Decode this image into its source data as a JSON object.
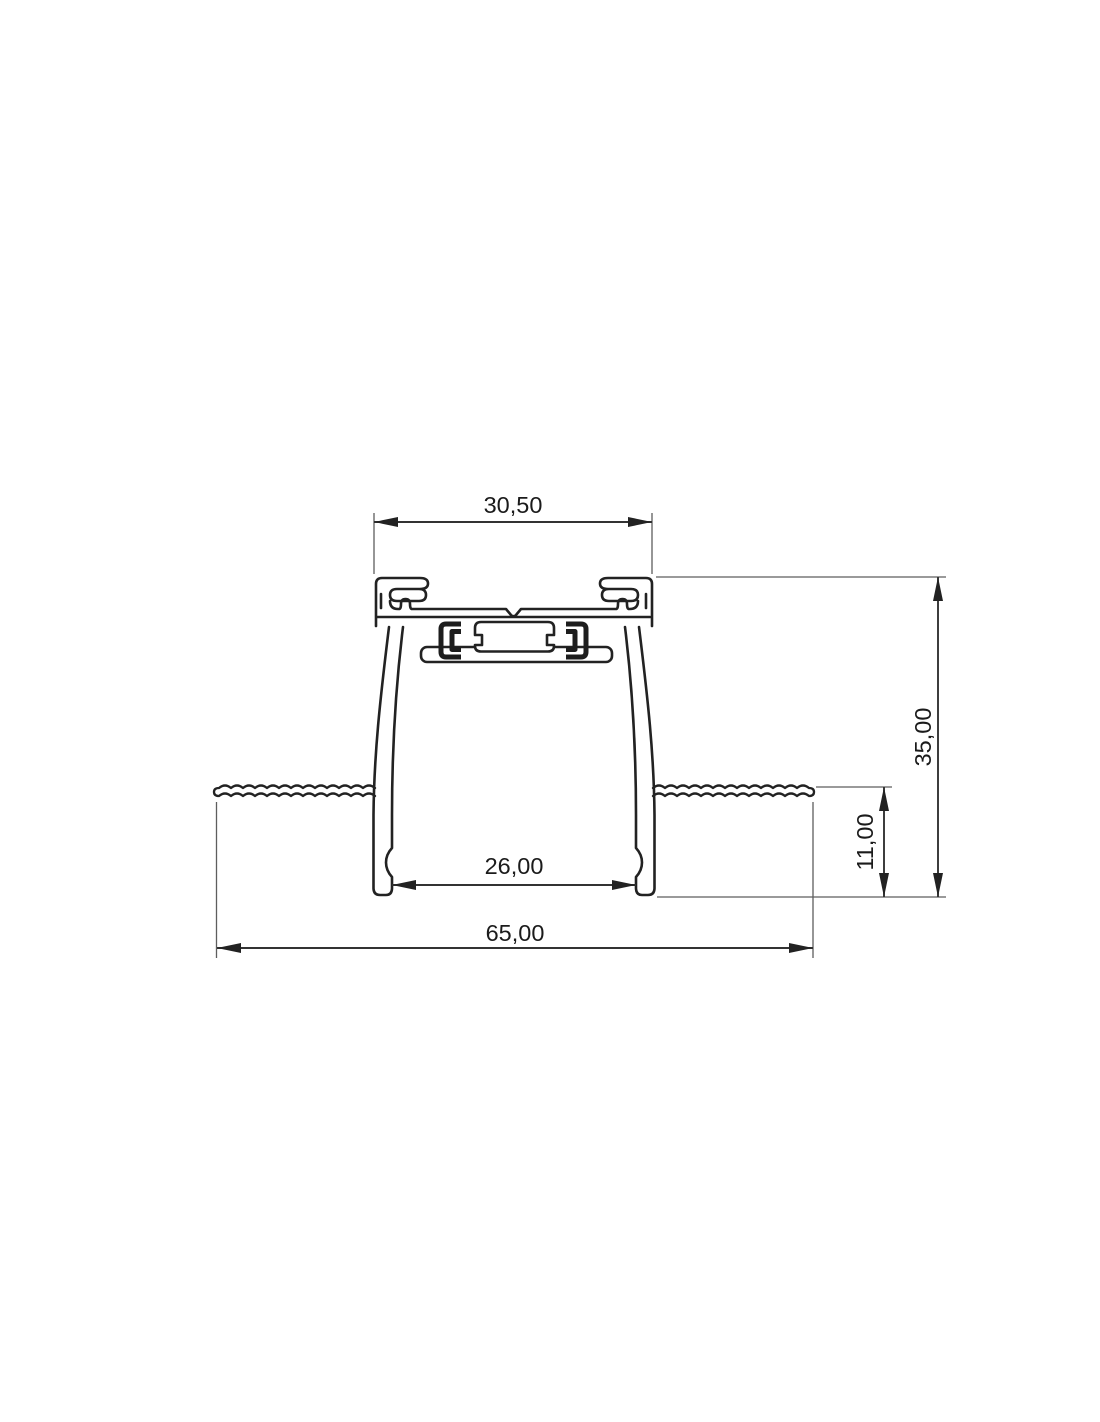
{
  "drawing": {
    "kind": "technical-drawing-cross-section",
    "style": {
      "background": "#ffffff",
      "outline_color": "#222222",
      "dimension_color": "#333333",
      "extension_color": "#5e5e5e",
      "text_color": "#1b1b1b"
    },
    "dimensions": {
      "top_width": {
        "label": "30,50",
        "value": 30.5,
        "orientation": "horizontal",
        "location": "top"
      },
      "overall_height": {
        "label": "35,00",
        "value": 35.0,
        "orientation": "vertical",
        "location": "right-outer"
      },
      "recess_depth": {
        "label": "11,00",
        "value": 11.0,
        "orientation": "vertical",
        "location": "right-inner"
      },
      "inner_opening_width": {
        "label": "26,00",
        "value": 26.0,
        "orientation": "horizontal",
        "location": "between-legs"
      },
      "overall_width": {
        "label": "65,00",
        "value": 65.0,
        "orientation": "horizontal",
        "location": "bottom"
      }
    }
  }
}
